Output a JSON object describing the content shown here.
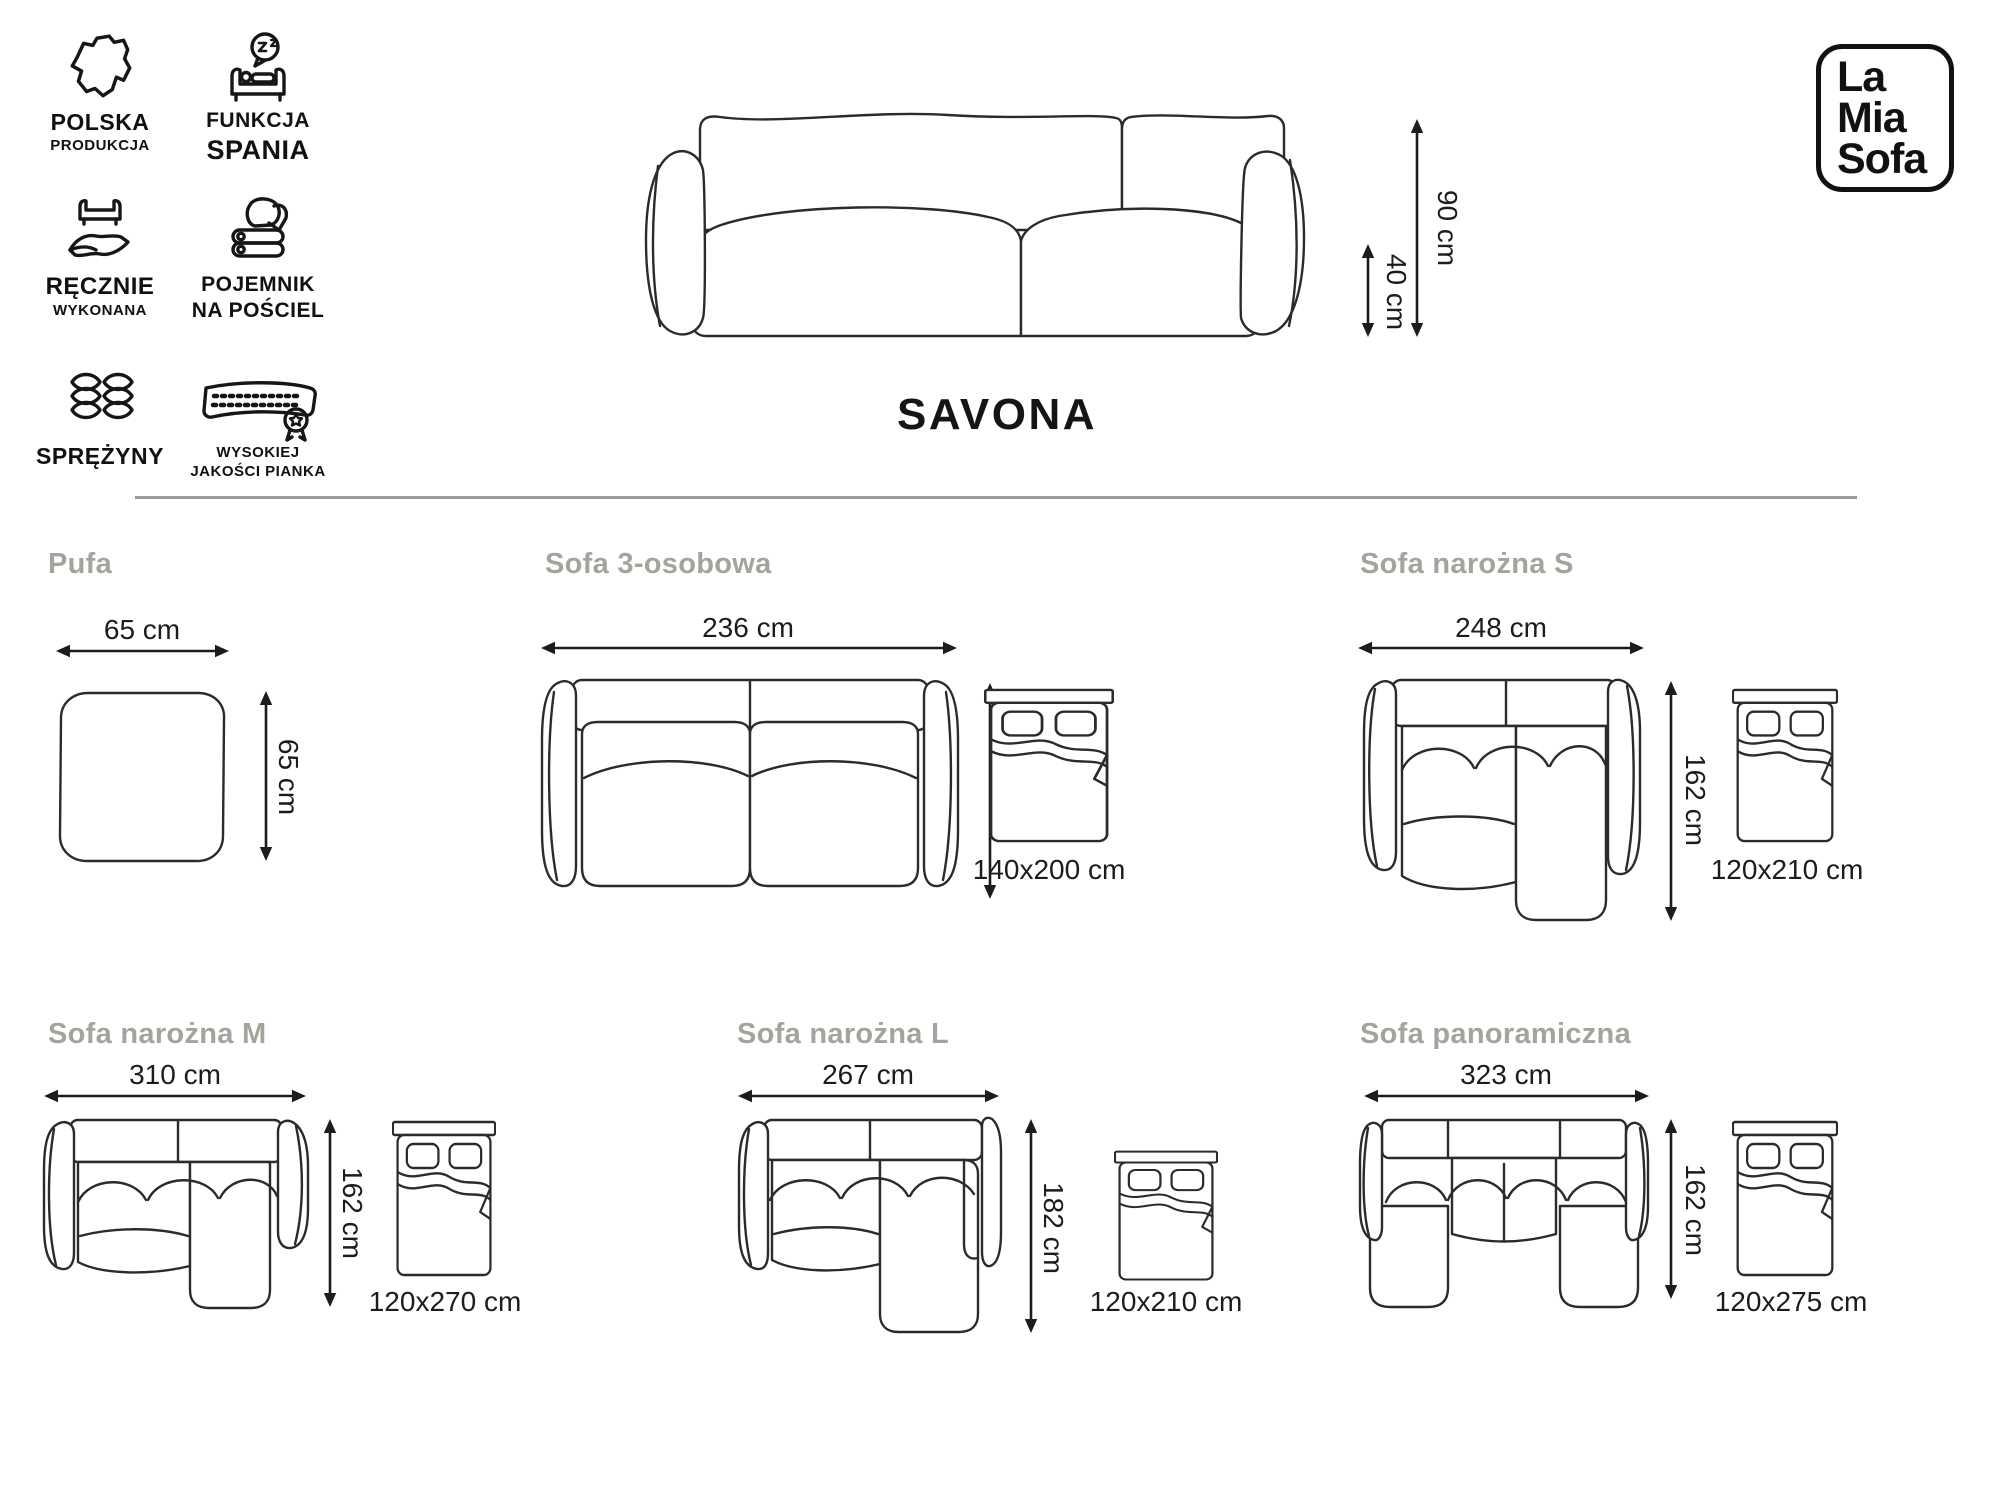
{
  "brand": {
    "line1": "La",
    "line2": "Mia",
    "line3": "Sofa"
  },
  "product_title": "SAVONA",
  "badges": [
    {
      "label1": "POLSKA",
      "label2": "PRODUKCJA",
      "icon": "poland-map-icon"
    },
    {
      "label1": "FUNKCJA",
      "label2": "SPANIA",
      "icon": "sleep-function-icon"
    },
    {
      "label1": "RĘCZNIE",
      "label2": "WYKONANA",
      "icon": "handmade-icon"
    },
    {
      "label1": "POJEMNIK",
      "label2": "NA POŚCIEL",
      "icon": "bedding-storage-icon"
    },
    {
      "label1": "SPRĘŻYNY",
      "label2": "",
      "icon": "springs-icon"
    },
    {
      "label1": "WYSOKIEJ",
      "label2": "JAKOŚCI PIANKA",
      "icon": "foam-quality-icon"
    }
  ],
  "main_dimensions": {
    "height": "90 cm",
    "seat_height": "40 cm"
  },
  "variants": [
    {
      "name": "Pufa",
      "width": "65 cm",
      "depth": "65 cm",
      "bed": ""
    },
    {
      "name": "Sofa 3-osobowa",
      "width": "236 cm",
      "depth": "105 cm",
      "bed": "140x200 cm"
    },
    {
      "name": "Sofa narożna S",
      "width": "248 cm",
      "depth": "162 cm",
      "bed": "120x210 cm"
    },
    {
      "name": "Sofa narożna M",
      "width": "310 cm",
      "depth": "162 cm",
      "bed": "120x270 cm"
    },
    {
      "name": "Sofa narożna L",
      "width": "267 cm",
      "depth": "182 cm",
      "bed": "120x210 cm"
    },
    {
      "name": "Sofa panoramiczna",
      "width": "323 cm",
      "depth": "162 cm",
      "bed": "120x275 cm"
    }
  ]
}
